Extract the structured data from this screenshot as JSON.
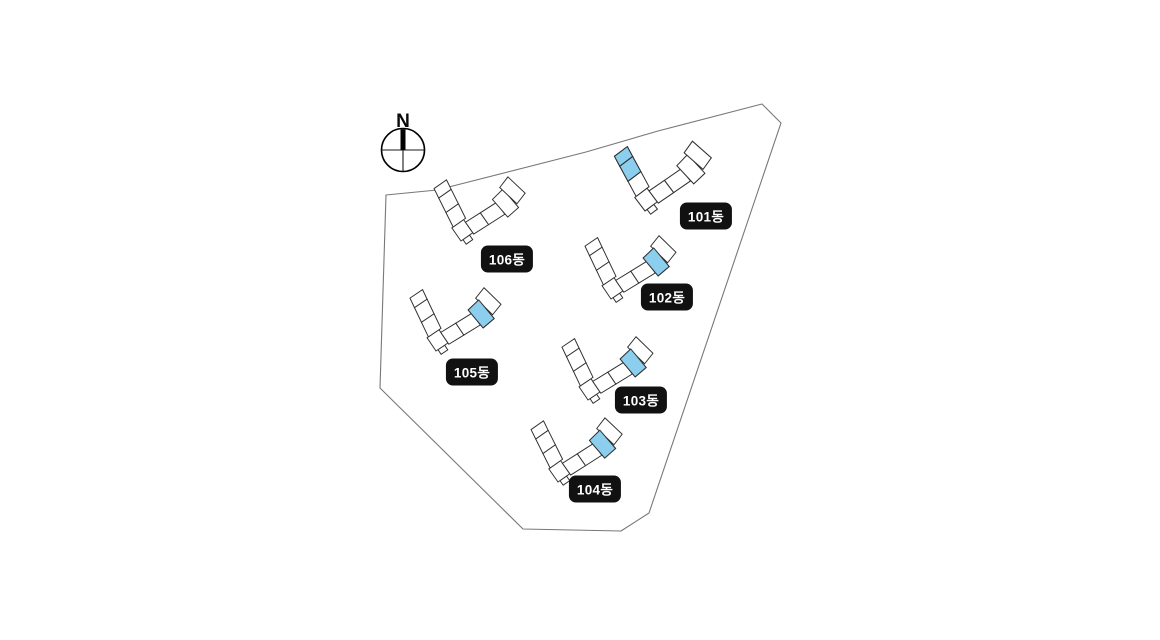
{
  "page": {
    "width_px": 1160,
    "height_px": 640,
    "background": "#ffffff"
  },
  "compass": {
    "label": "N",
    "style": "left:403px;top:131px"
  },
  "site": {
    "boundary_points": "386,195 437,190 586,152 658,131 762,104 781,123 649,513 621,531 523,529 380,388",
    "colors": {
      "highlight_blue": "#8CCEED",
      "building_outline": "#2f2f2f",
      "boundary_line": "#787878",
      "label_bg": "#111111",
      "label_text": "#ffffff"
    }
  },
  "buildings": {
    "b101": {
      "label": "101동",
      "transform": "translate(645,211) rotate(-37) scale(0.85)",
      "label_style": "left:706px;top:216px",
      "highlighted_units": "2 units at end of north-west wing"
    },
    "b102": {
      "label": "102동",
      "transform": "translate(611,299) rotate(-34) scale(0.8)",
      "label_style": "left:667px;top:297px",
      "highlighted_units": "1 unit on east wing near end"
    },
    "b103": {
      "label": "103동",
      "transform": "translate(588,400) rotate(-34) scale(0.8)",
      "label_style": "left:641px;top:400px",
      "highlighted_units": "1 unit on east wing near end"
    },
    "b104": {
      "label": "104동",
      "transform": "translate(558,482) rotate(-35) scale(0.8)",
      "label_style": "left:595px;top:489px",
      "highlighted_units": "1 unit on east wing near end"
    },
    "b105": {
      "label": "105동",
      "transform": "translate(436,351) rotate(-34) scale(0.8)",
      "label_style": "left:472px;top:372px",
      "highlighted_units": "1 unit on east wing near end"
    },
    "b106": {
      "label": "106동",
      "transform": "translate(461,241) rotate(-35) scale(0.8)",
      "label_style": "left:507px;top:259px",
      "highlighted_units": "none"
    }
  }
}
